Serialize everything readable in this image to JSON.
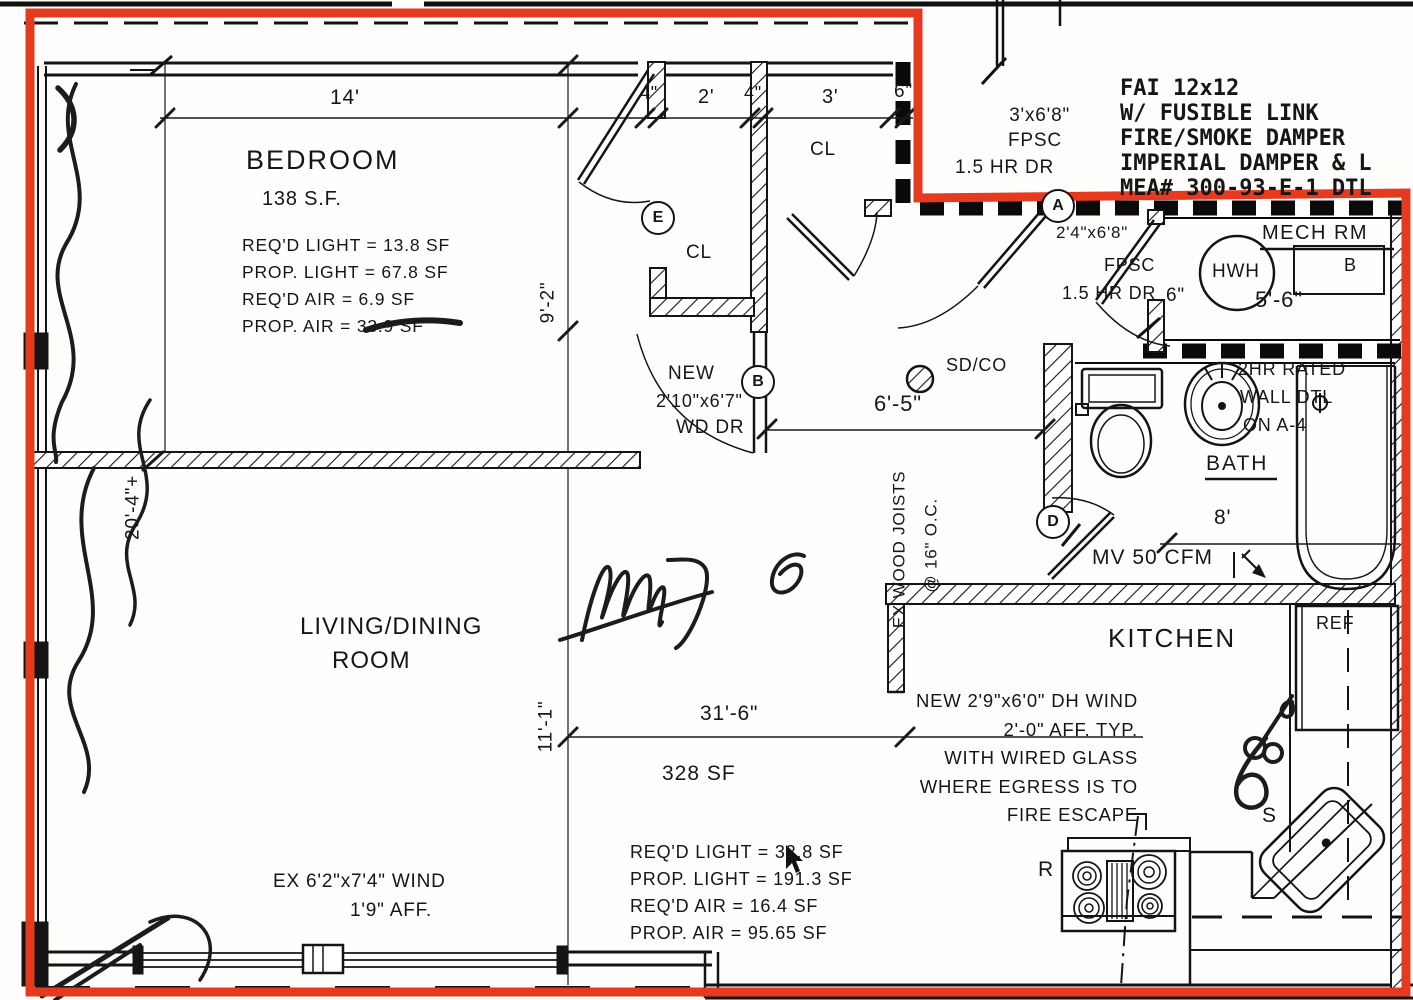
{
  "drawing": {
    "red_color": "#e63a20",
    "notes": {
      "fai": [
        "FAI 12x12",
        "W/ FUSIBLE LINK",
        "FIRE/SMOKE DAMPER",
        "IMPERIAL DAMPER & L",
        "MEA# 300-93-E-1 DTL"
      ],
      "entry_door": [
        "3'x6'8\"",
        "FPSC",
        "1.5 HR DR"
      ],
      "mech_door": [
        "2'4\"x6'8\"",
        "FPSC",
        "1.5 HR DR"
      ],
      "bedroom_door": [
        "NEW",
        "2'10\"x6'7\"",
        "WD DR"
      ],
      "rated_wall": [
        "2HR RATED",
        "WALL DTL",
        "ON A-4"
      ],
      "kitchen_window": [
        "NEW 2'9\"x6'0\" DH WIND",
        "2'-0\" AFF. TYP.",
        "WITH WIRED GLASS",
        "WHERE EGRESS IS TO",
        "FIRE ESCAPE"
      ],
      "living_window": [
        "EX 6'2\"x7'4\" WIND",
        "1'9\" AFF."
      ],
      "joists": [
        "EX WOOD JOISTS",
        "@ 16\" O.C."
      ],
      "smoke_detector": "SD/CO",
      "mech_vent": "MV 50 CFM"
    },
    "rooms": {
      "bedroom": {
        "name": "BEDROOM",
        "area": "138 S.F.",
        "stats": [
          "REQ'D LIGHT = 13.8 SF",
          "PROP. LIGHT = 67.8 SF",
          "REQ'D AIR = 6.9 SF",
          "PROP. AIR = 33.9 SF"
        ]
      },
      "living": {
        "name1": "LIVING/DINING",
        "name2": "ROOM",
        "area": "328 SF",
        "stats": [
          "REQ'D LIGHT = 32.8 SF",
          "PROP. LIGHT = 191.3 SF",
          "REQ'D AIR = 16.4 SF",
          "PROP. AIR = 95.65 SF"
        ]
      },
      "kitchen": {
        "name": "KITCHEN"
      },
      "bath": {
        "name": "BATH"
      },
      "mech": {
        "name": "MECH RM"
      },
      "closet1": "CL",
      "closet2": "CL"
    },
    "fixtures": {
      "water_heater": "HWH",
      "fridge": "REF",
      "range": "R",
      "sink": "S",
      "mech_box": "B"
    },
    "dims": {
      "d14": "14'",
      "d4a": "4\"",
      "d2": "2'",
      "d4b": "4\"",
      "d3": "3'",
      "d6a": "6\"",
      "d9_2": "9'-2\"",
      "d20_4": "20'-4\"+",
      "d6_5": "6'-5\"",
      "d5_6": "5'-6\"",
      "d6b": "6\"",
      "d8": "8'",
      "d31_6": "31'-6\"",
      "d11_1": "11'-1\""
    },
    "tags": {
      "a": "A",
      "b": "B",
      "d": "D",
      "e": "E"
    }
  }
}
